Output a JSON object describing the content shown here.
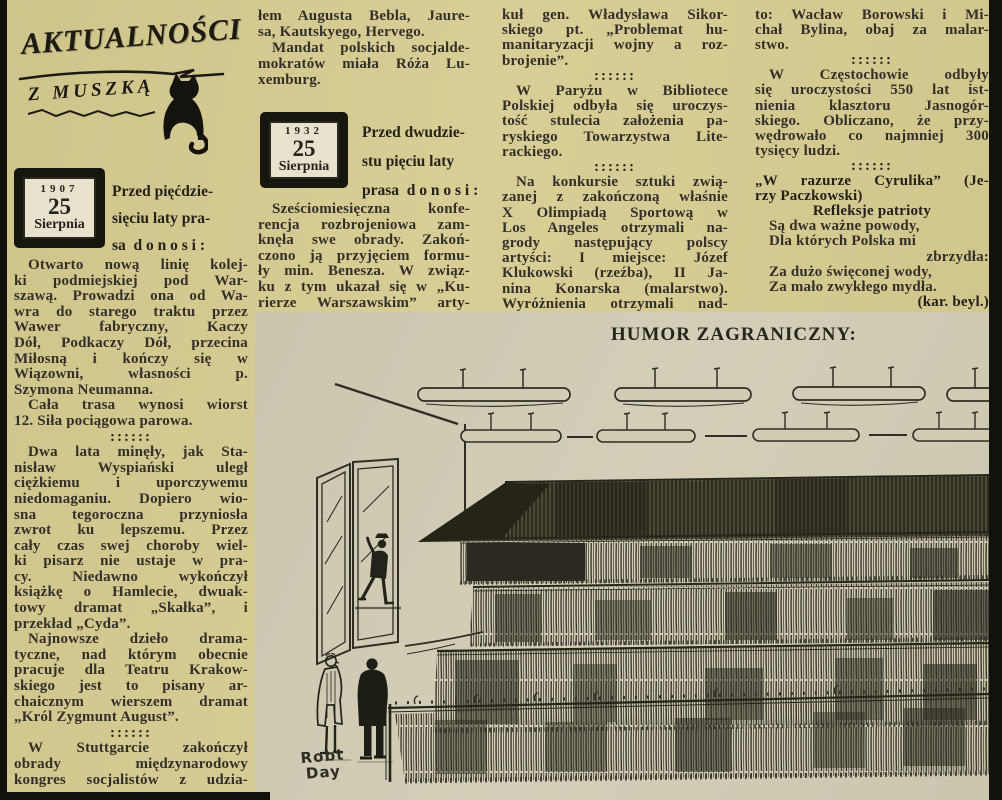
{
  "masthead": {
    "title": "AKTUALNOŚCI",
    "subtitle": "Z MUSZKĄ"
  },
  "separator_glyph": "::::::",
  "colors": {
    "paper_yellow": "#d6cc90",
    "paper_tan": "#d2ccb4",
    "ink": "#32302a",
    "badge_cream": "#e8e2cd"
  },
  "col1": {
    "badge": {
      "year": "1907",
      "day": "25",
      "month": "Sierpnia"
    },
    "intro": [
      {
        "t": "Przed pięćdzie-",
        "e": 1
      },
      {
        "t": "sięciu laty pra-",
        "e": 1
      },
      {
        "t": "sa  d o n o s i :",
        "e": 1
      }
    ],
    "blocks": [
      {
        "t": "Otwarto nową linię kolej-",
        "i": 1
      },
      {
        "t": "ki podmiejskiej pod War-"
      },
      {
        "t": "szawą. Prowadzi ona od Wa-"
      },
      {
        "t": "wra do starego traktu przez"
      },
      {
        "t": "Wawer fabryczny, Kaczy"
      },
      {
        "t": "Dół, Podkaczy Dół, przecina"
      },
      {
        "t": "Miłosną i kończy się w"
      },
      {
        "t": "Wiązowni, własności p."
      },
      {
        "t": "Szymona Neumanna.",
        "e": 1
      },
      {
        "t": "Cała trasa wynosi wiorst",
        "i": 1
      },
      {
        "t": "12. Siła pociągowa parowa.",
        "e": 1
      },
      {
        "s": 1
      },
      {
        "t": "Dwa lata minęły, jak Sta-",
        "i": 1
      },
      {
        "t": "nisław Wyspiański uległ"
      },
      {
        "t": "ciężkiemu i uporczywemu"
      },
      {
        "t": "niedomaganiu. Dopiero wio-"
      },
      {
        "t": "sna tegoroczna przyniosła"
      },
      {
        "t": "zwrot ku lepszemu. Przez"
      },
      {
        "t": "cały czas swej choroby wiel-"
      },
      {
        "t": "ki pisarz nie ustaje w pra-"
      },
      {
        "t": "cy. Niedawno wykończył"
      },
      {
        "t": "książkę o Hamlecie, dwuak-"
      },
      {
        "t": "towy dramat „Skałka”, i"
      },
      {
        "t": "przekład „Cyda”.",
        "e": 1
      },
      {
        "t": "Najnowsze dzieło drama-",
        "i": 1
      },
      {
        "t": "tyczne, nad którym obecnie"
      },
      {
        "t": "pracuje dla Teatru Krakow-"
      },
      {
        "t": "skiego jest to pisany ar-"
      },
      {
        "t": "chaicznym wierszem dramat"
      },
      {
        "t": "„Król Zygmunt August”.",
        "e": 1
      },
      {
        "s": 1
      },
      {
        "t": "W Stuttgarcie zakończył",
        "i": 1
      },
      {
        "t": "obrady międzynarodowy"
      },
      {
        "t": "kongres socjalistów z udzia-"
      }
    ]
  },
  "col2": {
    "top": [
      {
        "t": "łem Augusta Bebla, Jaure-"
      },
      {
        "t": "sa, Kautskyego, Hervego.",
        "e": 1
      },
      {
        "t": "Mandat polskich socjalde-",
        "i": 1
      },
      {
        "t": "mokratów miała Róża Lu-"
      },
      {
        "t": "xemburg.",
        "e": 1
      }
    ],
    "badge": {
      "year": "1932",
      "day": "25",
      "month": "Sierpnia"
    },
    "intro": [
      {
        "t": "Przed dwudzie-",
        "e": 1
      },
      {
        "t": "stu pięciu laty",
        "e": 1
      },
      {
        "t": "prasa  d o n o s i :",
        "e": 1
      }
    ],
    "para": [
      {
        "t": "Sześciomiesięczna konfe-",
        "i": 1
      },
      {
        "t": "rencja rozbrojeniowa zam-"
      },
      {
        "t": "knęła swe obrady. Zakoń-"
      },
      {
        "t": "czono ją przyjęciem formu-"
      },
      {
        "t": "ły min. Benesza. W związ-"
      },
      {
        "t": "ku z tym ukazał się w „Ku-"
      },
      {
        "t": "rierze Warszawskim” arty-"
      }
    ]
  },
  "col3": {
    "blocks": [
      {
        "t": "kuł gen. Władysława Sikor-"
      },
      {
        "t": "skiego pt. „Problemat hu-"
      },
      {
        "t": "manitaryzacji wojny a roz-"
      },
      {
        "t": "brojenie”.",
        "e": 1
      },
      {
        "s": 1
      },
      {
        "t": "W Paryżu w Bibliotece",
        "i": 1
      },
      {
        "t": "Polskiej odbyła się uroczys-"
      },
      {
        "t": "tość stulecia założenia pa-"
      },
      {
        "t": "ryskiego Towarzystwa Lite-"
      },
      {
        "t": "rackiego.",
        "e": 1
      },
      {
        "s": 1
      },
      {
        "t": "Na konkursie sztuki zwią-",
        "i": 1
      },
      {
        "t": "zanej z zakończoną właśnie"
      },
      {
        "t": "X Olimpiadą Sportową w"
      },
      {
        "t": "Los Angeles otrzymali na-"
      },
      {
        "t": "grody następujący polscy"
      },
      {
        "t": "artyści: I miejsce: Józef"
      },
      {
        "t": "Klukowski (rzeźba), II Ja-"
      },
      {
        "t": "nina Konarska (malarstwo)."
      },
      {
        "t": "Wyróżnienia otrzymali nad-"
      }
    ]
  },
  "col4": {
    "blocks": [
      {
        "t": "to: Wacław Borowski i Mi-"
      },
      {
        "t": "chał Bylina, obaj za malar-"
      },
      {
        "t": "stwo.",
        "e": 1
      },
      {
        "s": 1
      },
      {
        "t": "W Częstochowie odbyły",
        "i": 1
      },
      {
        "t": "się uroczystości 550 lat ist-"
      },
      {
        "t": "nienia klasztoru Jasnogór-"
      },
      {
        "t": "skiego. Obliczano, że przy-"
      },
      {
        "t": "wędrowało co najmniej 300"
      },
      {
        "t": "tysięcy ludzi.",
        "e": 1
      },
      {
        "s": 1
      },
      {
        "t": "„W razurze Cyrulika” (Je-",
        "b": 1
      },
      {
        "t": "rzy Paczkowski)",
        "b": 1,
        "e": 1
      },
      {
        "t": "Refleksje patrioty",
        "b": 1,
        "a": "c"
      },
      {
        "t": "Są dwa ważne powody,",
        "e": 1,
        "i": 1
      },
      {
        "t": "Dla których Polska mi",
        "e": 1,
        "i": 1
      },
      {
        "t": "zbrzydła:",
        "a": "r"
      },
      {
        "t": "Za dużo święconej wody,",
        "e": 1,
        "i": 1
      },
      {
        "t": "Za mało zwykłego mydła.",
        "e": 1,
        "i": 1
      },
      {
        "t": "(kar. beyl.)",
        "a": "r",
        "b": 1
      }
    ]
  },
  "cartoon": {
    "heading": "HUMOR ZAGRANICZNY:",
    "signature": [
      "Robt",
      "Day"
    ]
  }
}
